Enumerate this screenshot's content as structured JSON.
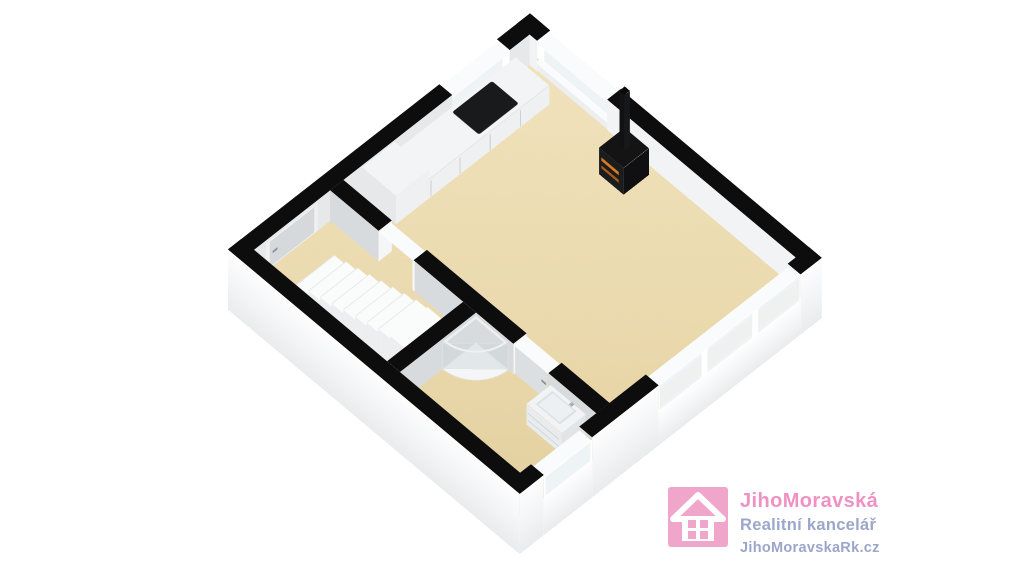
{
  "floorplan": {
    "view": "3d-isometric-cutaway-floor-plan",
    "colors": {
      "floor": "#ead9ad",
      "floor_light": "#f0e2bc",
      "wall_cut": "#0d0d0e",
      "wall_inner_light": "#f1f3f4",
      "wall_inner_mid": "#e6e8ea",
      "wall_inner_dark": "#d8dbdd",
      "wall_outer_top": "#fdfdfe",
      "wall_outer_bottom": "#e9ebec",
      "glass": "#eef3f6",
      "frame": "#fafbfc",
      "counter": "#f3f4f5",
      "counter_front": "#eef0f1",
      "cooktop": "#191a1c",
      "stove": "#1b1c1e",
      "ember": "#d97a22",
      "ember_dark": "#a8581a",
      "step_top": "#fafbfb",
      "step_side": "#eceeef",
      "door": "#d6d9db",
      "door_light": "#dcdfe1",
      "handle": "#8b9196",
      "shower_glass": "rgba(203,212,218,0.45)",
      "vanity": "#f1f3f4",
      "vanity_front": "#e9ecee",
      "basin": "#dde1e4"
    },
    "features": [
      "kitchen-counter",
      "cooktop",
      "wood-stove",
      "chimney-flue",
      "staircase",
      "corner-shower",
      "sink-vanity",
      "entry-door",
      "interior-doorway",
      "bathroom-door",
      "windows",
      "panorama-glazing",
      "railing-posts"
    ]
  },
  "branding": {
    "company": "JihoMoravská",
    "tagline": "Realitní kancelář",
    "website": "JihoMoravskaRk.cz",
    "logo_icon": "house-icon",
    "colors": {
      "pink": "#f0a6cb",
      "text_pink": "#ee92c3",
      "text_blue": "#9ba6ca",
      "white": "#ffffff"
    }
  }
}
